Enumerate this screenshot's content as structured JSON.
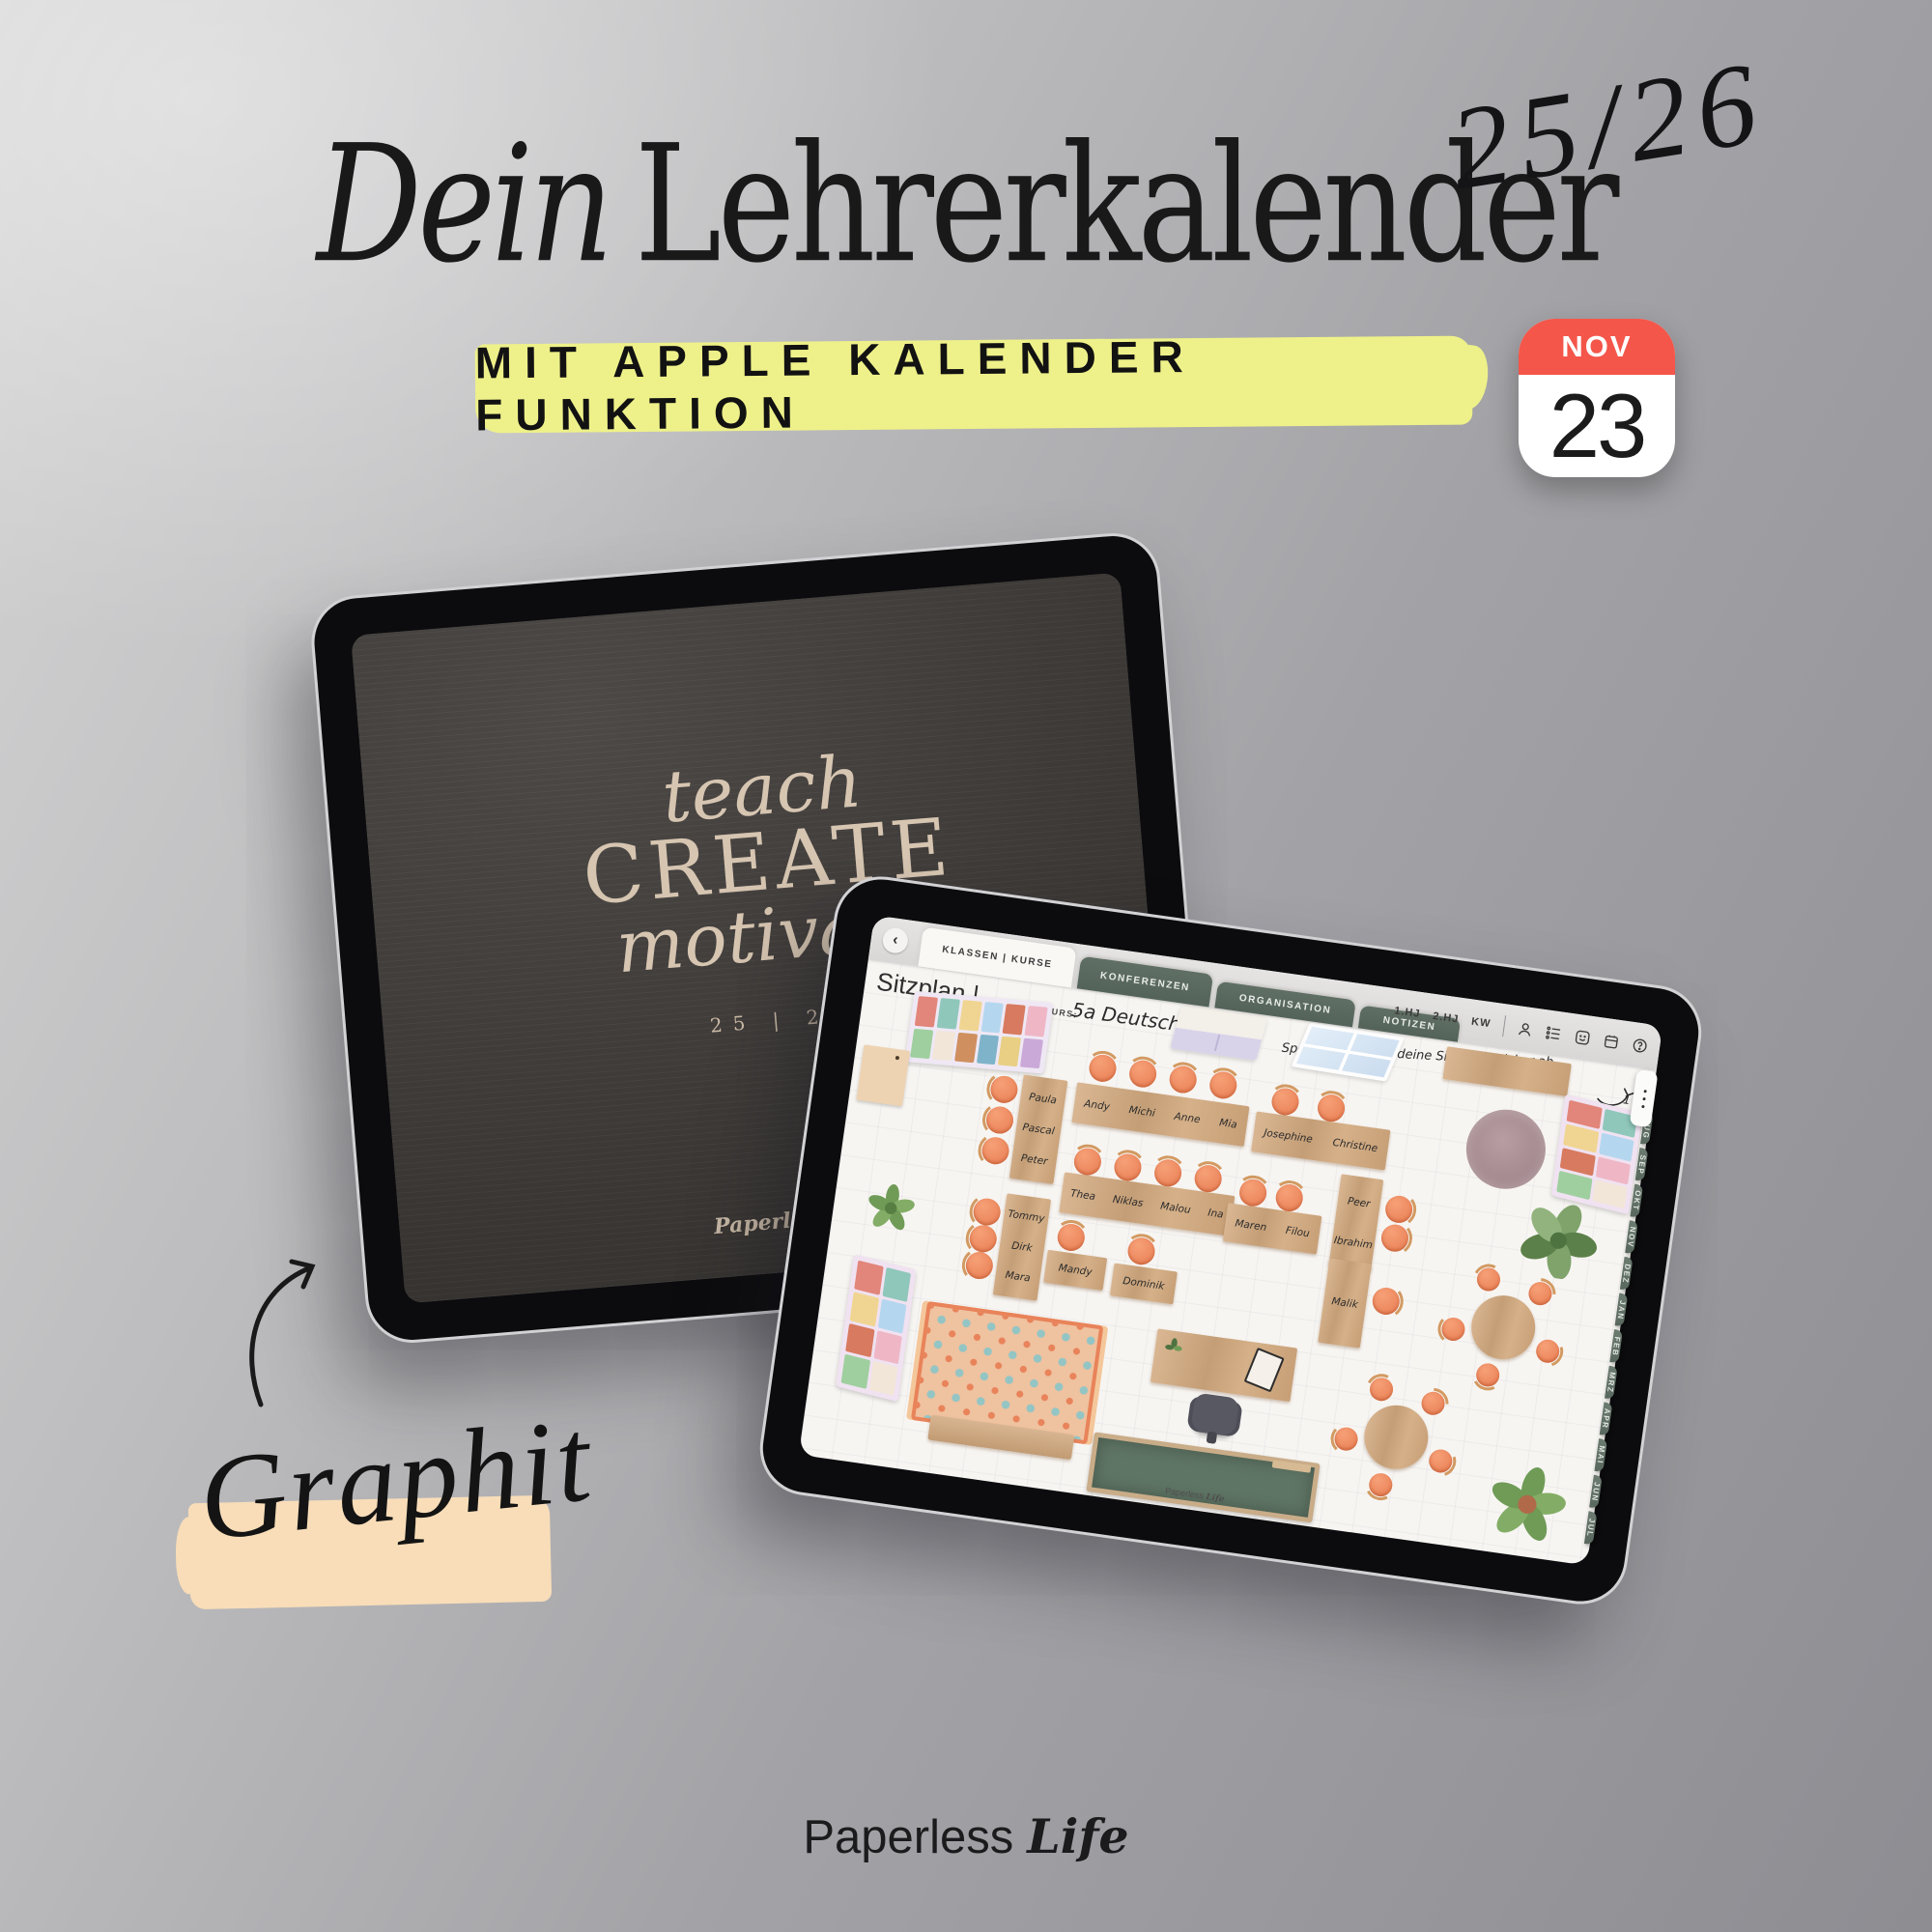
{
  "page": {
    "title": {
      "italic": "Dein",
      "regular": "Lehrerkalender"
    },
    "year_script": "25/26",
    "banner": "MIT APPLE KALENDER FUNKTION",
    "calendar": {
      "month": "NOV",
      "day": "23"
    },
    "color_label": "Graphit",
    "brand": {
      "word": "Paperless",
      "accent": "Life"
    },
    "colors": {
      "banner_yellow": "#eef189",
      "peach_highlight": "#f8ddb8",
      "calendar_red": "#f4564a",
      "tab_green": "#5d6c61",
      "chair_orange": "#e87c52",
      "desk_wood": "#cda57d",
      "cover_dark": "#3f3b38",
      "cover_text": "#d6c5b1"
    }
  },
  "cover": {
    "line1": "teach",
    "line2": "CREATE",
    "line3": "motivate",
    "year": "25 | 26",
    "brand": "Paperless Life"
  },
  "app": {
    "tabs": [
      "KLASSEN | KURSE",
      "KONFERENZEN",
      "ORGANISATION",
      "NOTIZEN"
    ],
    "title": "Sitzplan |",
    "class_label": "KLASSE | KURS:",
    "class_value": "5a Deutsch",
    "toolbar": {
      "labels": [
        "1.HJ",
        "2.HJ",
        "KW"
      ]
    },
    "note": "Speichere dir hier deine Sitzplan-Sticker ab",
    "page_number": "1",
    "months": [
      "AUG",
      "SEP",
      "OKT",
      "NOV",
      "DEZ",
      "JAN",
      "FEB",
      "MRZ",
      "APR",
      "MAI",
      "JUN",
      "JUL"
    ],
    "canvas_brand_word": "Paperless",
    "canvas_brand_accent": "Life",
    "seating": {
      "groups": [
        {
          "names": [
            "Paula",
            "Pascal",
            "Peter"
          ]
        },
        {
          "names": [
            "Andy",
            "Michi",
            "Anne",
            "Mia"
          ]
        },
        {
          "names": [
            "Tommy",
            "Dirk",
            "Mara"
          ]
        },
        {
          "names": [
            "Thea",
            "Niklas",
            "Malou",
            "Ina"
          ]
        },
        {
          "names": [
            "Mandy"
          ]
        },
        {
          "names": [
            "Dominik"
          ]
        },
        {
          "names": [
            "Josephine",
            "Christine"
          ]
        },
        {
          "names": [
            "Peer",
            "Ibrahim"
          ]
        },
        {
          "names": [
            "Maren",
            "Filou"
          ]
        },
        {
          "names": [
            "Malik"
          ]
        }
      ]
    }
  }
}
